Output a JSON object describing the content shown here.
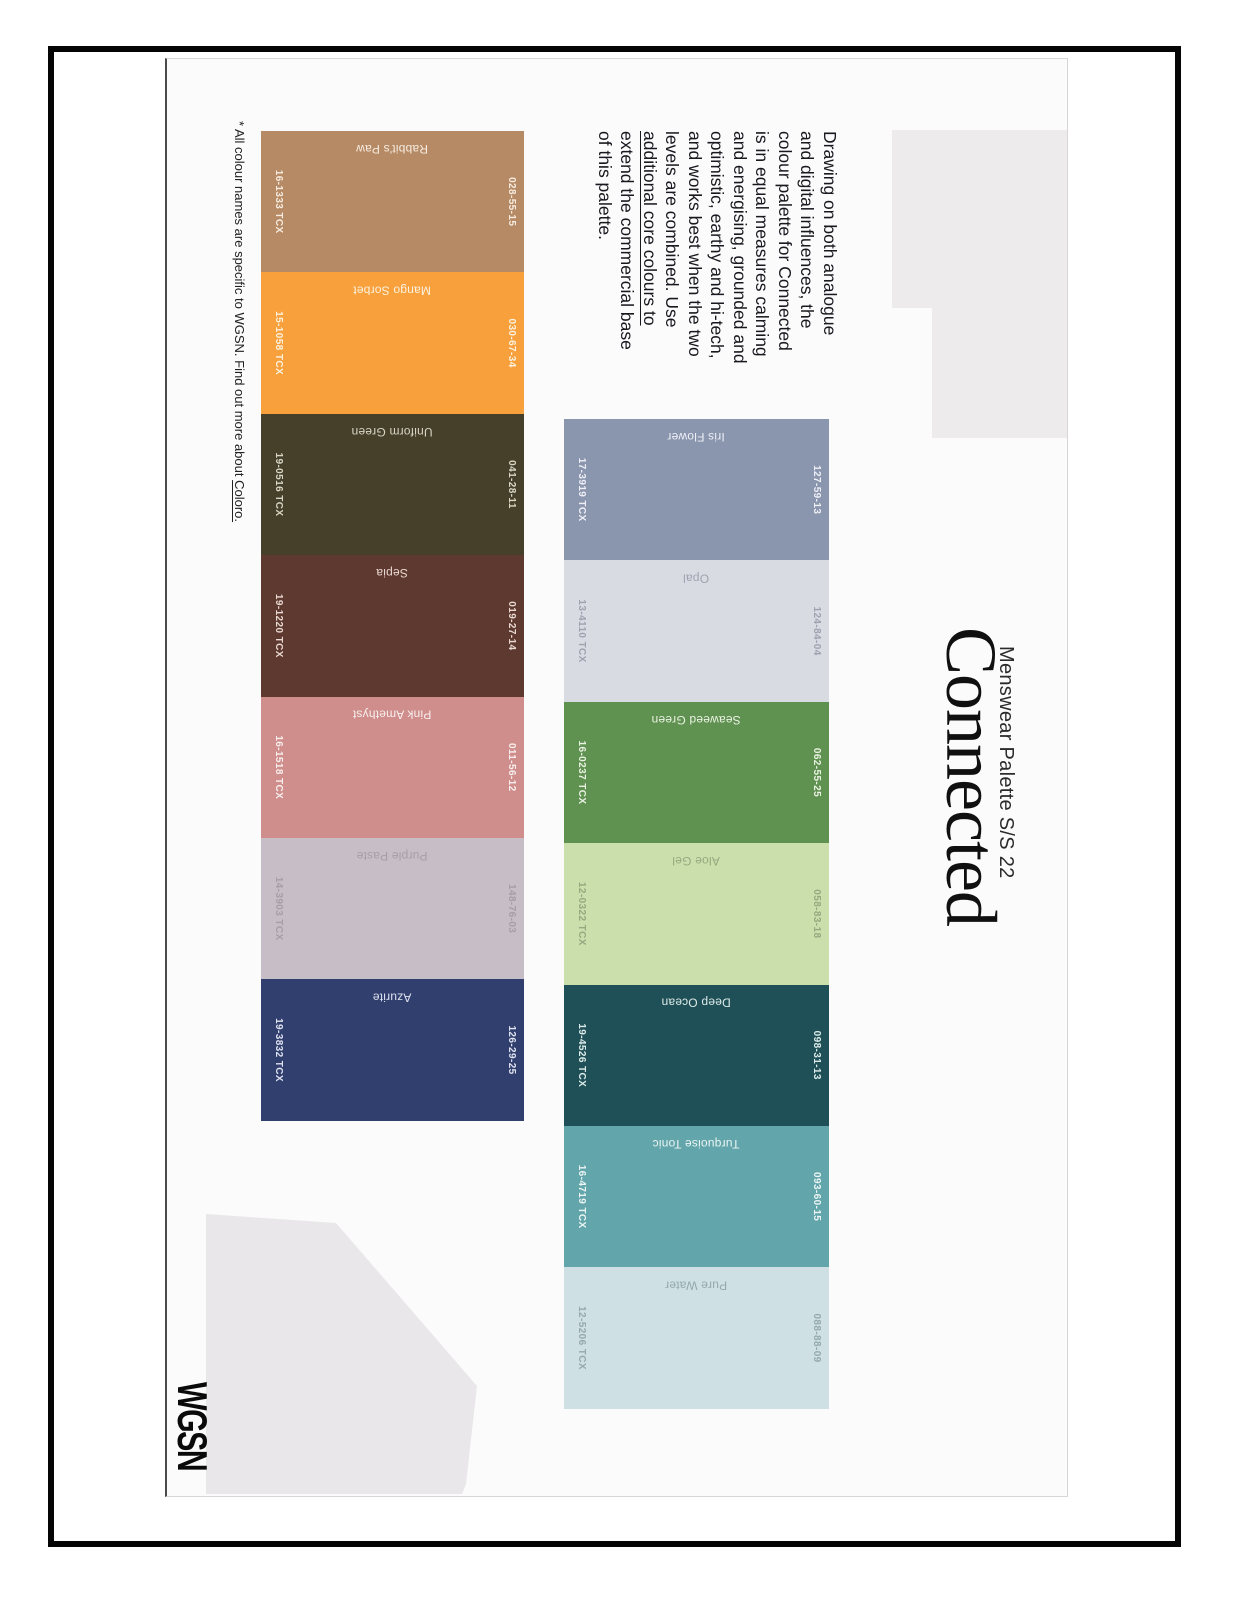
{
  "document": {
    "subtitle": "Menswear Palette S/S 22",
    "title": "Connected",
    "logo": "WGSN"
  },
  "paragraph": {
    "lines": [
      "Drawing on both analogue",
      "and digital influences, the",
      "colour palette for Connected",
      "is in equal measures calming",
      "and energising, grounded and",
      "optimistic, earthy and hi-tech,",
      "and works best when the two",
      "levels are combined. Use",
      "additional core colours to",
      "extend the commercial base",
      "of this palette."
    ]
  },
  "palette": {
    "rows": [
      {
        "label": "main palette",
        "chips": [
          {
            "name": "Iris Flower",
            "coloro": "127-59-13",
            "tcx": "17-3919 TCX",
            "color": "#8a95ae",
            "text_color": "#eef0f6"
          },
          {
            "name": "Opal",
            "coloro": "124-84-04",
            "tcx": "13-4110 TCX",
            "color": "#d9dbe3",
            "text_color": "#9fa1af"
          },
          {
            "name": "Seaweed Green",
            "coloro": "062-55-25",
            "tcx": "16-0237 TCX",
            "color": "#5f9150",
            "text_color": "#eaf2e3"
          },
          {
            "name": "Aloe Gel",
            "coloro": "058-83-18",
            "tcx": "12-0322 TCX",
            "color": "#cbdfad",
            "text_color": "#95a87f"
          },
          {
            "name": "Deep Ocean",
            "coloro": "098-31-13",
            "tcx": "19-4526 TCX",
            "color": "#205057",
            "text_color": "#dcebe9"
          },
          {
            "name": "Turquoise Tonic",
            "coloro": "093-60-15",
            "tcx": "16-4719 TCX",
            "color": "#62a5ab",
            "text_color": "#ecf5f4"
          },
          {
            "name": "Pure Water",
            "coloro": "088-88-09",
            "tcx": "12-5206 TCX",
            "color": "#cfe0e4",
            "text_color": "#93a9ad"
          }
        ]
      },
      {
        "label": "additional core colours",
        "chips": [
          {
            "name": "Rabbit's Paw",
            "coloro": "028-55-15",
            "tcx": "16-1333 TCX",
            "color": "#b68a64",
            "text_color": "#f6ece1"
          },
          {
            "name": "Mango Sorbet",
            "coloro": "030-67-34",
            "tcx": "15-1058 TCX",
            "color": "#f7a03c",
            "text_color": "#fdf2df"
          },
          {
            "name": "Uniform Green",
            "coloro": "041-28-11",
            "tcx": "19-0516 TCX",
            "color": "#46402b",
            "text_color": "#d9d6c5"
          },
          {
            "name": "Sepia",
            "coloro": "019-27-14",
            "tcx": "19-1220 TCX",
            "color": "#5e392f",
            "text_color": "#e9d9d3"
          },
          {
            "name": "Pink Amethyst",
            "coloro": "011-56-12",
            "tcx": "16-1518 TCX",
            "color": "#cf8e8b",
            "text_color": "#f8efee"
          },
          {
            "name": "Purple Paste",
            "coloro": "148-76-03",
            "tcx": "14-3903 TCX",
            "color": "#c7bdc7",
            "text_color": "#a79da8"
          },
          {
            "name": "Azurite",
            "coloro": "126-29-25",
            "tcx": "19-3832 TCX",
            "color": "#303f6e",
            "text_color": "#dfe2ef"
          }
        ]
      }
    ]
  },
  "footnote": {
    "text": "* All colour names are specific to WGSN. Find out more about ",
    "link": "Coloro."
  }
}
